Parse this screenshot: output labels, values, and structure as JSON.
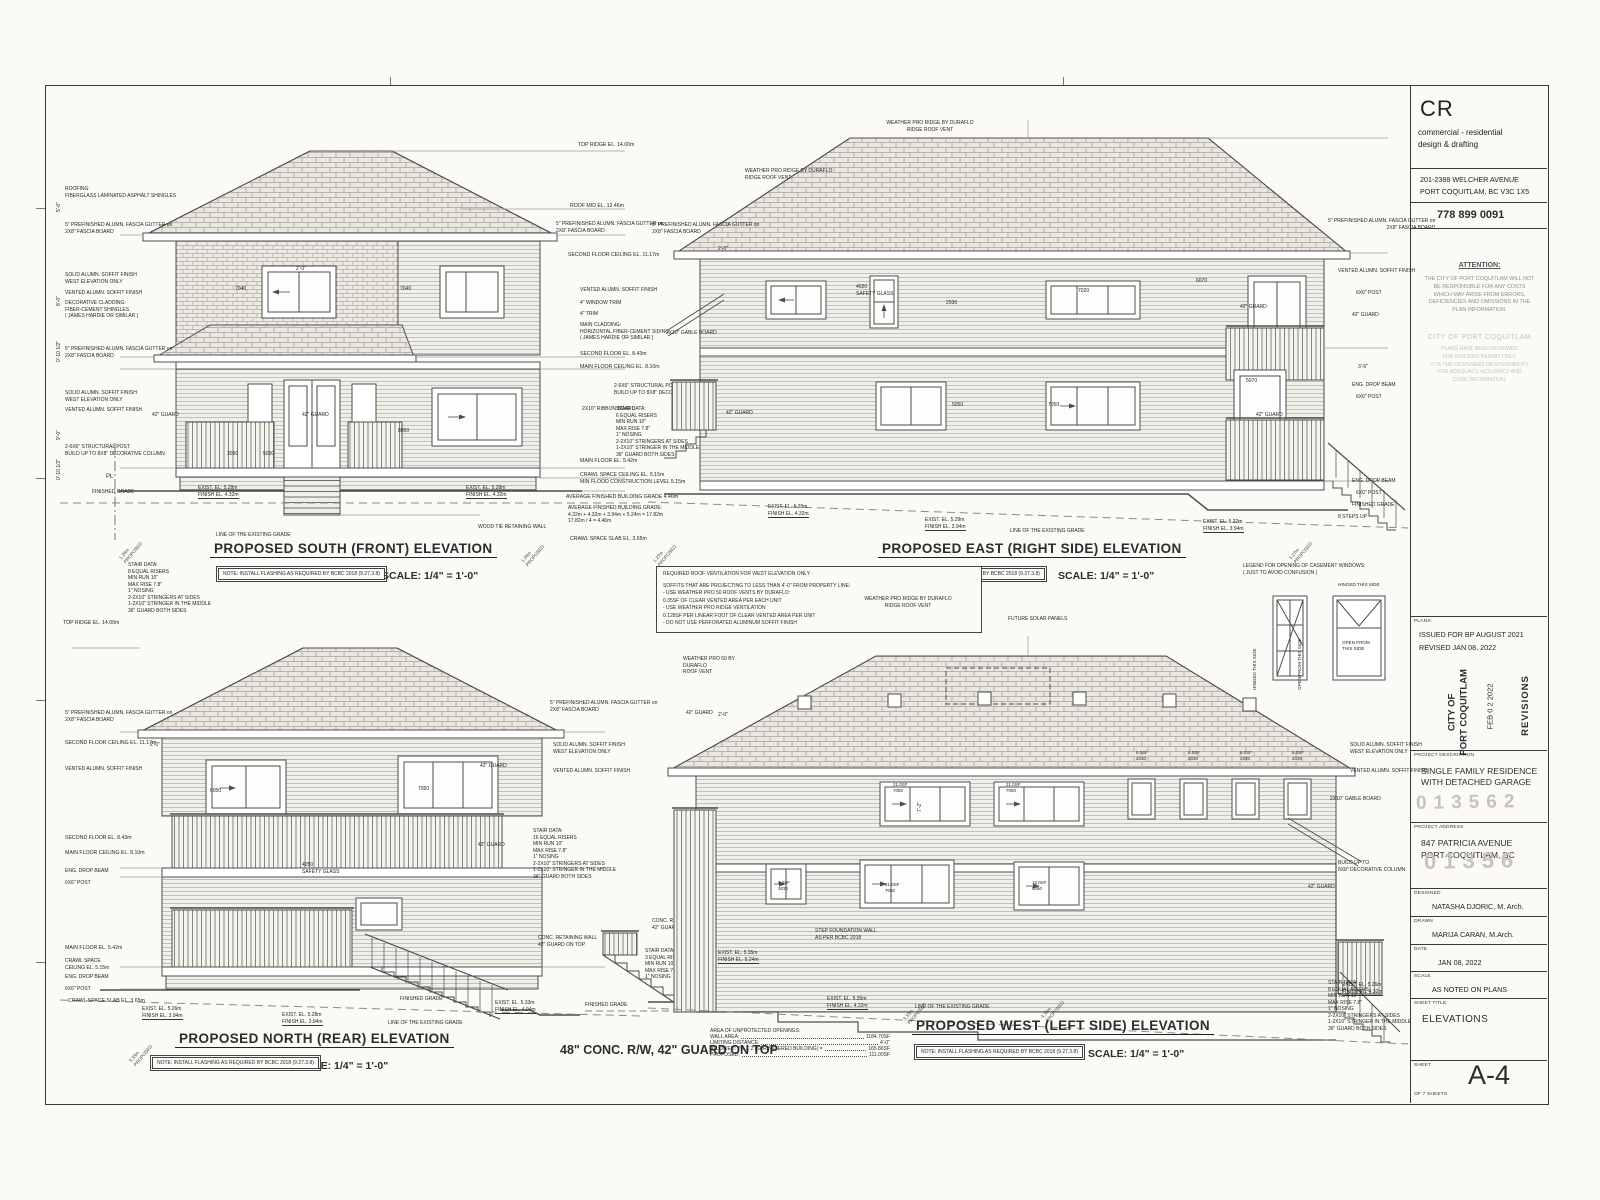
{
  "tb": {
    "logo": "CR",
    "sub1": "commercial - residential",
    "sub2": "design & drafting",
    "addr1": "201-2388 WELCHER AVENUE",
    "addr2": "PORT COQUITLAM, BC  V3C 1X5",
    "phone": "778 899 0091",
    "att_head": "ATTENTION:",
    "att_body": "THE CITY OF PORT COQUITLAM WILL NOT\nBE RESPONSIBLE FOR ANY COSTS\nWHICH MAY ARISE FROM ERRORS,\nDEFICIENCIES AND OMISSIONS IN THE\nPLAN INFORMATION.",
    "review_head": "CITY OF PORT COQUITLAM",
    "review_body": "PLANS HAVE BEEN REVIEWED\nFOR BUILDING PERMIT ONLY.\nIT IS THE DESIGNERS RESPONSIBILITY\nFOR ADEQUACY, ACCURACY AND\nCODE INFORMATION.",
    "plans_label": "PLANS:",
    "plans1": "ISSUED FOR BP AUGUST 2021",
    "plans2": "REVISED JAN 08, 2022",
    "stamp_city": "CITY OF\nPORT COQUITLAM",
    "stamp_date": "FEB 0 2 2022",
    "stamp_rev": "REVISIONS",
    "pd_label": "PROJECT DESCRIPTION",
    "pd_value": "SINGLE FAMILY RESIDENCE\nWITH DETACHED GARAGE",
    "pd_num": "013562",
    "pa_label": "PROJECT ADDRESS",
    "pa1": "847 PATRICIA AVENUE",
    "pa2": "PORT COQUITLAM, BC",
    "pa_num": "01356",
    "des_label": "DESIGNED",
    "des_value": "NATASHA DJORIC, M. Arch.",
    "drawn_label": "DRAWN",
    "drawn_value": "MARIJA CARAN, M.Arch.",
    "date_label": "DATE",
    "date_value": "JAN 08, 2022",
    "scale_label": "SCALE",
    "scale_value": "AS NOTED ON PLANS",
    "st_label": "SHEET TITLE",
    "st_value": "ELEVATIONS",
    "sh_label": "SHEET",
    "sh_value": "A-4",
    "sh_of": "OF 7 SHEETS"
  },
  "common": {
    "roofing": "ROOFING:\nFIBERGLASS LAMINATED ASPHALT SHINGLES",
    "fascia": "5\" PREFINISHED ALUMN. FASCIA GUTTER on\n2X8\" FASCIA BOARD",
    "solid": "SOLID ALUMN. SOFFIT FINISH\nWEST ELEVATION ONLY",
    "vented": "VENTED ALUMN. SOFFIT FINISH",
    "decor": "DECORATIVE CLADDING:\nFIBER-CEMENT SHINGLES\n( JAMES HARDIE OR SIMILAR )",
    "clad": "MAIN CLADDING:\nHORIZONTAL FIBER-CEMENT SIDING\n( JAMES HARDIE OR SIMILAR )",
    "ribbon": "2X10\" RIBBON BOARD",
    "wtrim": "4\" WINDOW TRIM",
    "trim": "4\" TRIM",
    "guard42": "42\" GUARD",
    "post66": "6X6\" POST",
    "dropbeam": "ENG. DROP BEAM",
    "pl": "PL",
    "fin_grade": "FINISHED GRADE",
    "grade_line": "LINE OF THE EXISTING GRADE",
    "post_build": "2-6X6\" STRUCTURAL POST\nBUILD UP TO 8X8\" DECORATIVE COLUMN",
    "gable": "2X10\" GABLE BOARD",
    "ridge_vent": "WEATHER PRO RIDGE BY DURAFLO\nRIDGE ROOF VENT",
    "vent50": "WEATHER PRO 50 BY\nDURAFLO\nROOF VENT",
    "conc_wall": "CONC. RETAINING WALL\n42\" GUARD ON TOP",
    "w2030": "6.0SF\n2030",
    "wood_tie": "WOOD TIE RETAINING WALL"
  },
  "levels": {
    "ridge": "TOP RIDGE EL. 14.00m",
    "roofmid": "ROOF MID EL. 12.46m",
    "sfc": "SECOND FLOOR CEILING EL. 11.17m",
    "sf": "SECOND FLOOR EL. 8.43m",
    "mfc": "MAIN FLOOR CEILING EL. 8.10m",
    "mf": "MAIN FLOOR EL. 5.42m",
    "csc": "CRAWL SPACE CEILING EL. 5.15m\nMIN FLOOD CONSTRUCTION LEVEL 5.15m",
    "csc2": "CRAWL SPACE\nCEILING EL. 5.15m",
    "afbg": "AVERAGE FINISHED BUILDING GRADE  4.46m",
    "afbg_calc": "AVERAGE FINISHED BUILDING GRADE:\n4.32m + 4.32m + 3.94m + 5.24m = 17.82m\n17.82m / 4 = 4.46m",
    "slab": "CRAWL SPACE SLAB EL. 3.65m"
  },
  "stairs": {
    "s2": "STAIR DATA:\n2 EQUAL RISERS\nMIN RUN 10\"\nMAX RISE 7.8\"\n1\" NOSING",
    "s3": "STAIR DATA:\n3 EQUAL RISERS\nMIN RUN 10\"\nMAX RISE 7.8\"\n1\" NOSING",
    "s6": "STAIR DATA:\n6 EQUAL RISERS\nMIN RUN 10\"\nMAX RISE 7.8\"\n1\" NOSING\n2-2X10\" STRINGERS AT SIDES\n1-2X10\" STRINGER IN THE MIDDLE\n36\" GUARD BOTH SIDES",
    "s8": "STAIR DATA:\n8 EQUAL RISERS\nMIN RUN 10\"\nMAX RISE 7.8\"\n1\" NOSING\n2-2X10\" STRINGERS AT SIDES\n1-2X10\" STRINGER IN THE MIDDLE\n36\" GUARD BOTH SIDES",
    "s16": "STAIR DATA:\n16 EQUAL RISERS\nMIN RUN 10\"\nMAX RISE 7.8\"\n1\" NOSING\n2-2X10\" STRINGERS AT SIDES\n1-2X10\" STRINGER IN THE MIDDLE\n36\" GUARD BOTH SIDES"
  },
  "south": {
    "title": "PROPOSED SOUTH (FRONT) ELEVATION",
    "scale": "SCALE: 1/4\" = 1'-0\"",
    "note": "NOTE: INSTALL FLASHING AS REQUIRED\nBY BCBC 2018 (9.27.3.8)",
    "w7040": "7040",
    "w3030": "3030",
    "w5030": "5030",
    "w8050": "8050",
    "gl": "EXIST. EL. 5.28m\nFINISH EL. 4.32m",
    "gr": "EXIST. EL. 5.28m\nFINISH EL. 4.32m",
    "prop": "1.26m\nPROPOSED"
  },
  "east": {
    "title": "PROPOSED EAST (RIGHT SIDE) ELEVATION",
    "scale": "SCALE: 1/4\" = 1'-0\"",
    "note": "NOTE: INSTALL FLASHING AS REQUIRED\nBY BCBC 2018 (9.27.3.8)",
    "w4020": "4020\nSAFETY GLASS",
    "w2036": "2036",
    "w7020": "7020",
    "w6070": "6070",
    "w5050": "5050",
    "w7050": "7050",
    "w5070": "5070",
    "steps8": "8 STEPS UP",
    "ga": "EXIST. EL. 5.39m\nFINISH EL. 4.32m",
    "gb": "EXIST. EL. 5.29m\nFINISH EL. 3.94m",
    "gc": "EXIST. EL. 5.27m\nFINISH EL. 3.94m",
    "prop": "1.27m\nPROPOSED"
  },
  "north": {
    "title": "PROPOSED NORTH (REAR) ELEVATION",
    "scale": "SCALE: 1/4\" = 1'-0\"",
    "note": "NOTE: INSTALL FLASHING AS REQUIRED\nBY BCBC 2018 (9.27.3.8)",
    "w6050": "6050",
    "w7050": "7050",
    "w4050": "4050\nSAFETY GLASS",
    "g1": "EXIST. EL. 5.26m\nFINISH EL. 3.94m",
    "g2": "EXIST. EL. 5.28m\nFINISH EL. 3.94m",
    "g3": "EXIST. EL. 5.33m\nFINISH EL. 4.04m",
    "prop": "3.33m\nPROPOSED"
  },
  "west": {
    "title": "PROPOSED WEST (LEFT SIDE) ELEVATION",
    "scale": "SCALE: 1/4\" = 1'-0\"",
    "note": "NOTE: INSTALL FLASHING AS REQUIRED\nBY BCBC 2018 (9.27.3.8)",
    "solar": "FUTURE SOLAR PANELS",
    "w7050a": "21.0SF\n7050",
    "w7050b": "21.0SF\n7050",
    "w7050c": "21.0SF\n7050",
    "w3030": "9.0SF\n3030",
    "w5050": "15.0SF\n5050",
    "stepfound": "STEP FOUNDATION WALL\nAS PER BCBC 2018",
    "build8x8": "BUILD UP TO\n8X8\" DECORATIVE COLUMN",
    "g1": "EXIST. EL. 5.35m\nFINISH EL. 5.24m",
    "g2": "EXIST. EL. 5.35m\nFINISH EL. 4.32m",
    "g3": "EXIST. EL. 5.26m\nFINISH EL. 4.32m",
    "prop1": "3.33m\nPROPOSED",
    "prop2": "3.35m\nPROPOSED",
    "conc_rw": "48\" CONC. R/W,\n42\" GUARD ON TOP",
    "open": {
      "head": "AREA OF UNPROTECTED OPENINGS:",
      "rows": [
        {
          "l": "WALL AREA:",
          "v": "1184.70SF"
        },
        {
          "l": "LIMITING DISTANCE:",
          "v": "4'-0\""
        },
        {
          "l": "ALLOWED: 7% X 2 (SPRINKLERED BUILDING) =",
          "v": "165.86SF"
        },
        {
          "l": "PROPOSED:",
          "v": "111.00SF"
        }
      ]
    }
  },
  "vent_note": {
    "head": "REQUIRED ROOF VENTILATION FOR WEST ELEVATION ONLY :",
    "body": "SOFFITS THAT ARE PROJECTING TO LESS THAN 4'-0\" FROM PROPERTY LINE:\n-   USE WEATHER PRO 50 ROOF VENTS BY DURAFLO:\n    0.35SF OF CLEAR VENTED AREA PER EACH UNIT\n-   USE WEATHER PRO RIDGE VENTILATION\n    0.128SF PER LINEAR FOOT OF CLEAR VENTED AREA PER UNIT\n-   DO NOT USE PERFORATED ALUMINUM SOFFIT FINISH"
  },
  "legend": {
    "head": "LEGEND FOR OPENING OF CASEMENT WINDOWS:\n( JUST TO AVOID CONFUSION )",
    "hinged": "HINGED THIS SIDE",
    "open_from": "OPEN FROM THIS SIDE",
    "hinged2": "HINGED THIS SIDE",
    "open_from2": "OPEN FROM\nTHIS SIDE"
  },
  "dims": {
    "a": "2'-0\"",
    "b": "5'-0\"",
    "c": "8'-0\"",
    "d": "0'-10 1/2\"",
    "e": "9'-0\"",
    "f": "20'-5\"",
    "g": "3'-6\"",
    "h": "7'-2\"",
    "i": "10'-1\""
  }
}
